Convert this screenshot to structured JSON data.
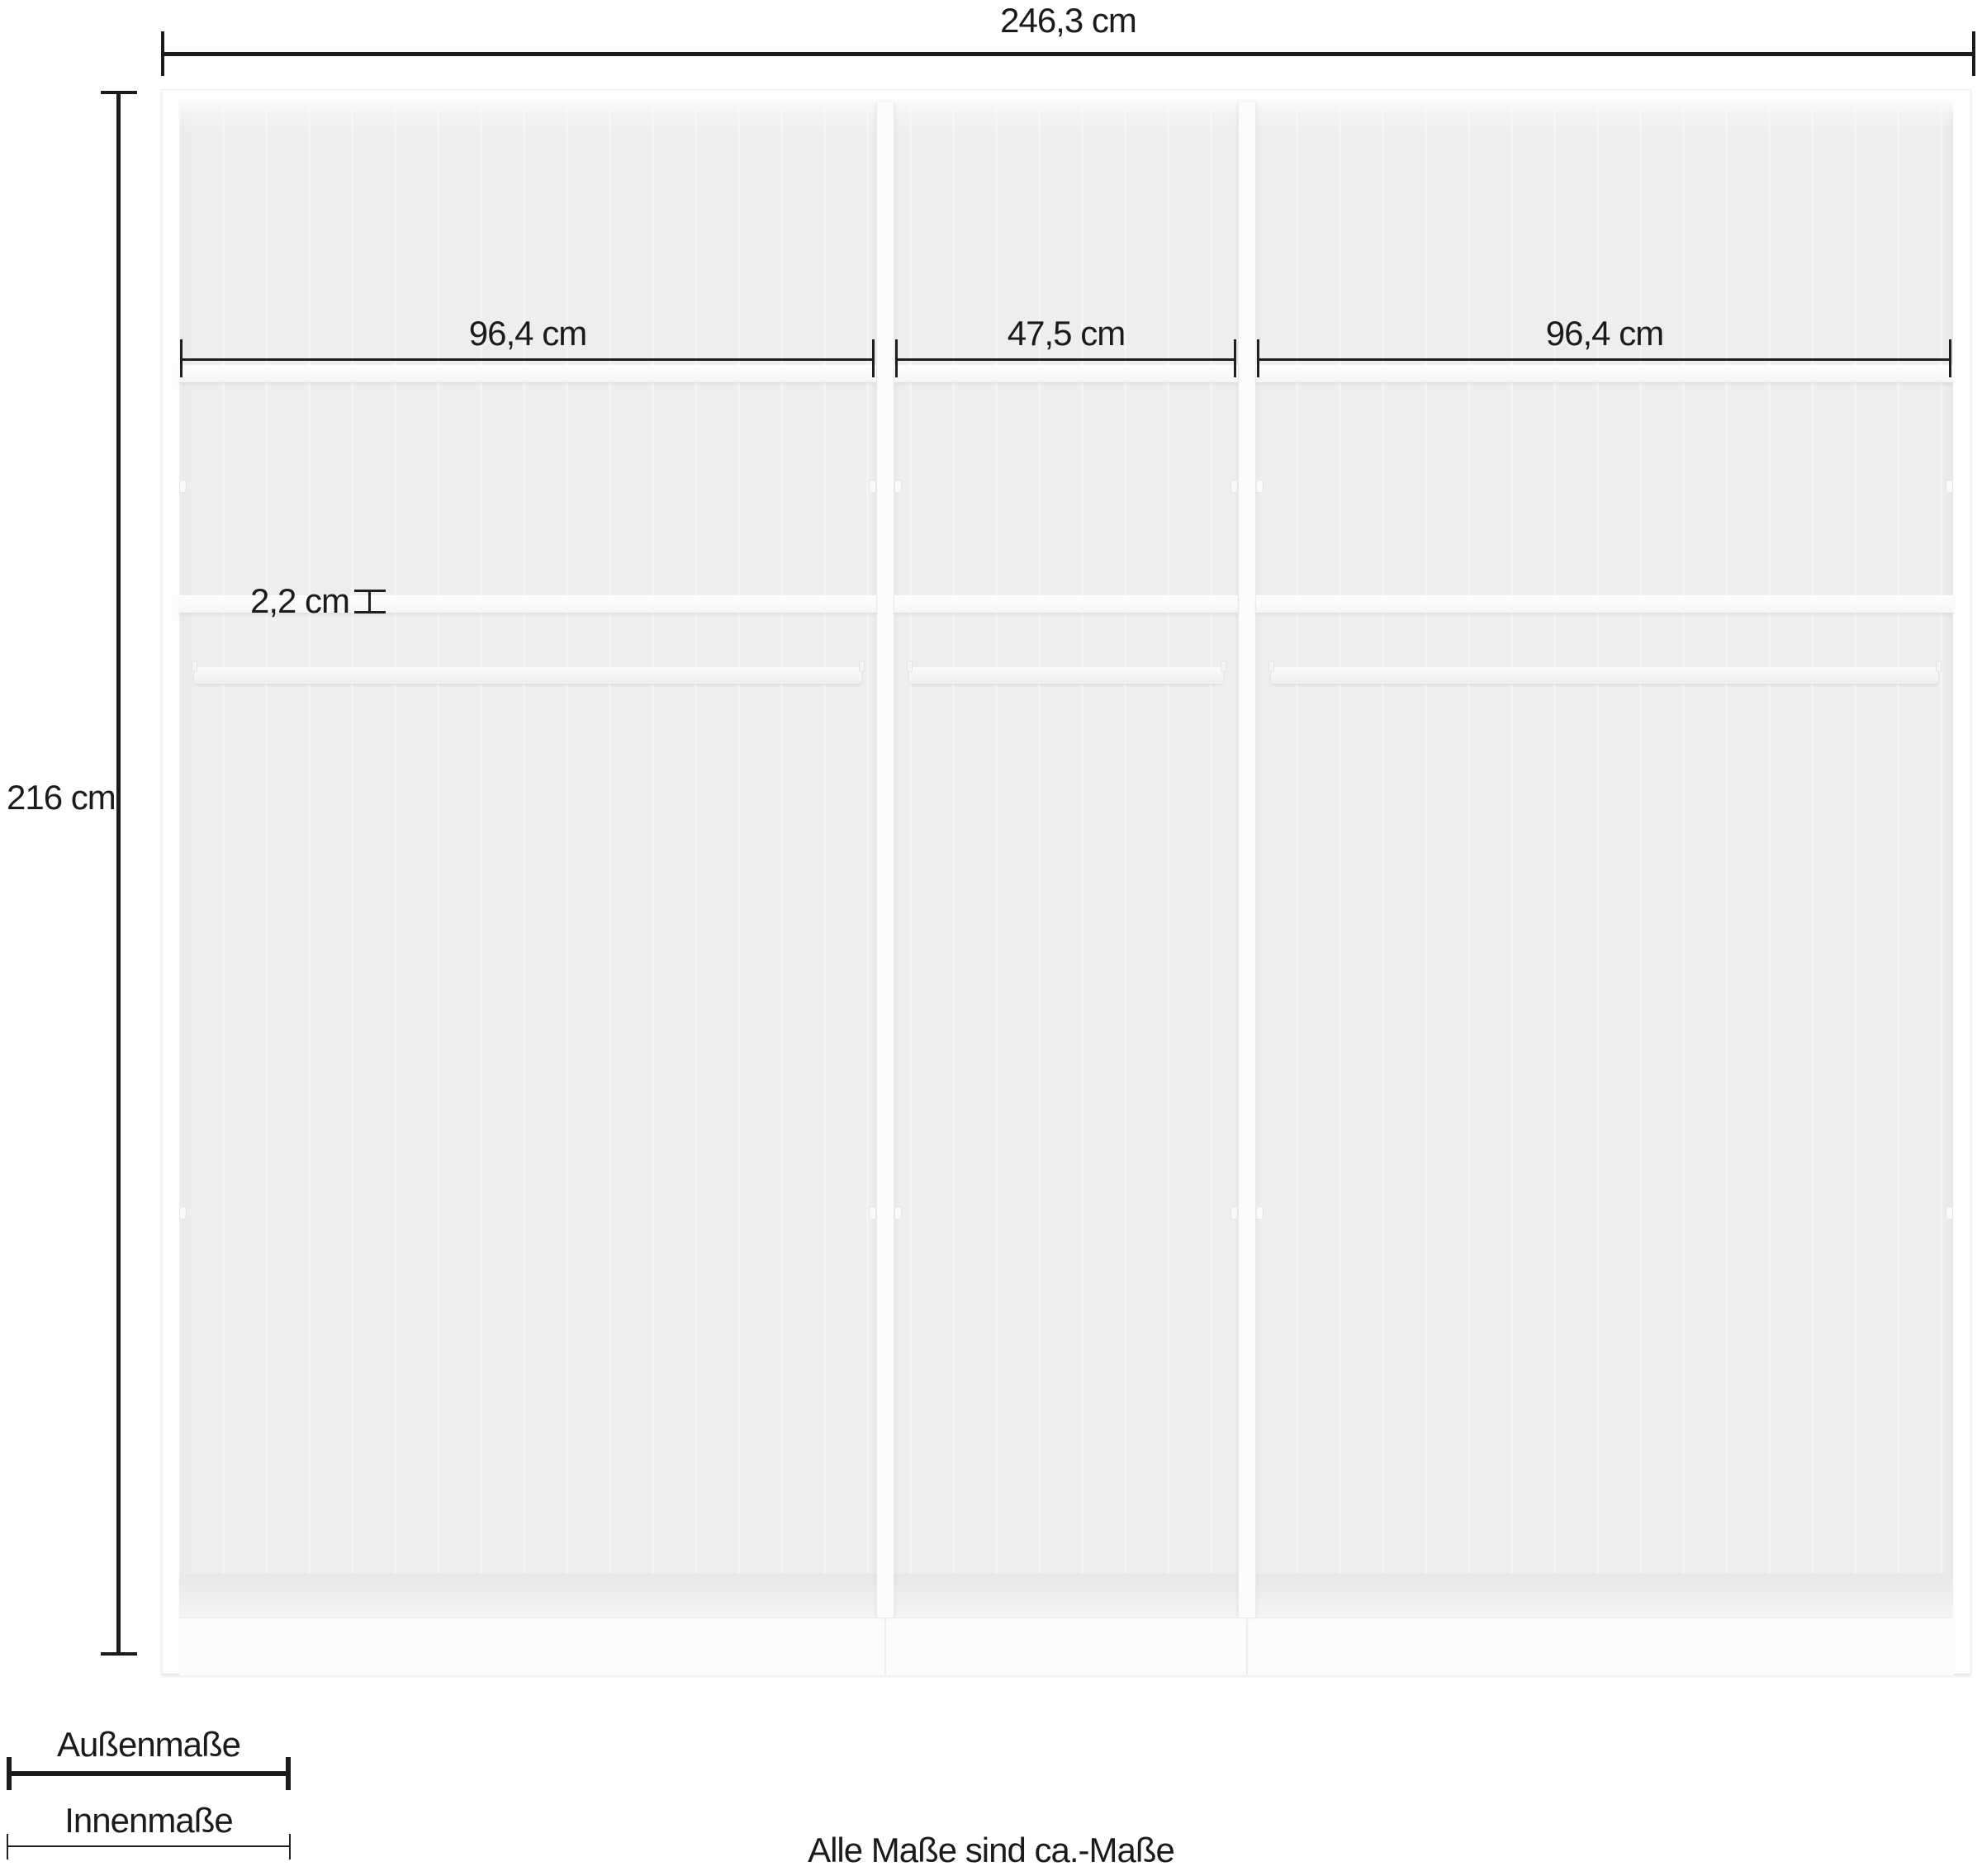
{
  "dimensions": {
    "outer_width": "246,3 cm",
    "outer_height": "216 cm",
    "shelf_thickness": "2,2 cm",
    "compartments": [
      {
        "label": "96,4 cm"
      },
      {
        "label": "47,5 cm"
      },
      {
        "label": "96,4 cm"
      }
    ]
  },
  "legend": {
    "outer_label": "Außenmaße",
    "inner_label": "Innenmaße"
  },
  "footnote": "Alle Maße sind ca.-Maße",
  "colors": {
    "line": "#1b1b1b",
    "cabinet": "#fdfdfc",
    "interior_back": "#f1f1ef",
    "background": "#ffffff"
  }
}
